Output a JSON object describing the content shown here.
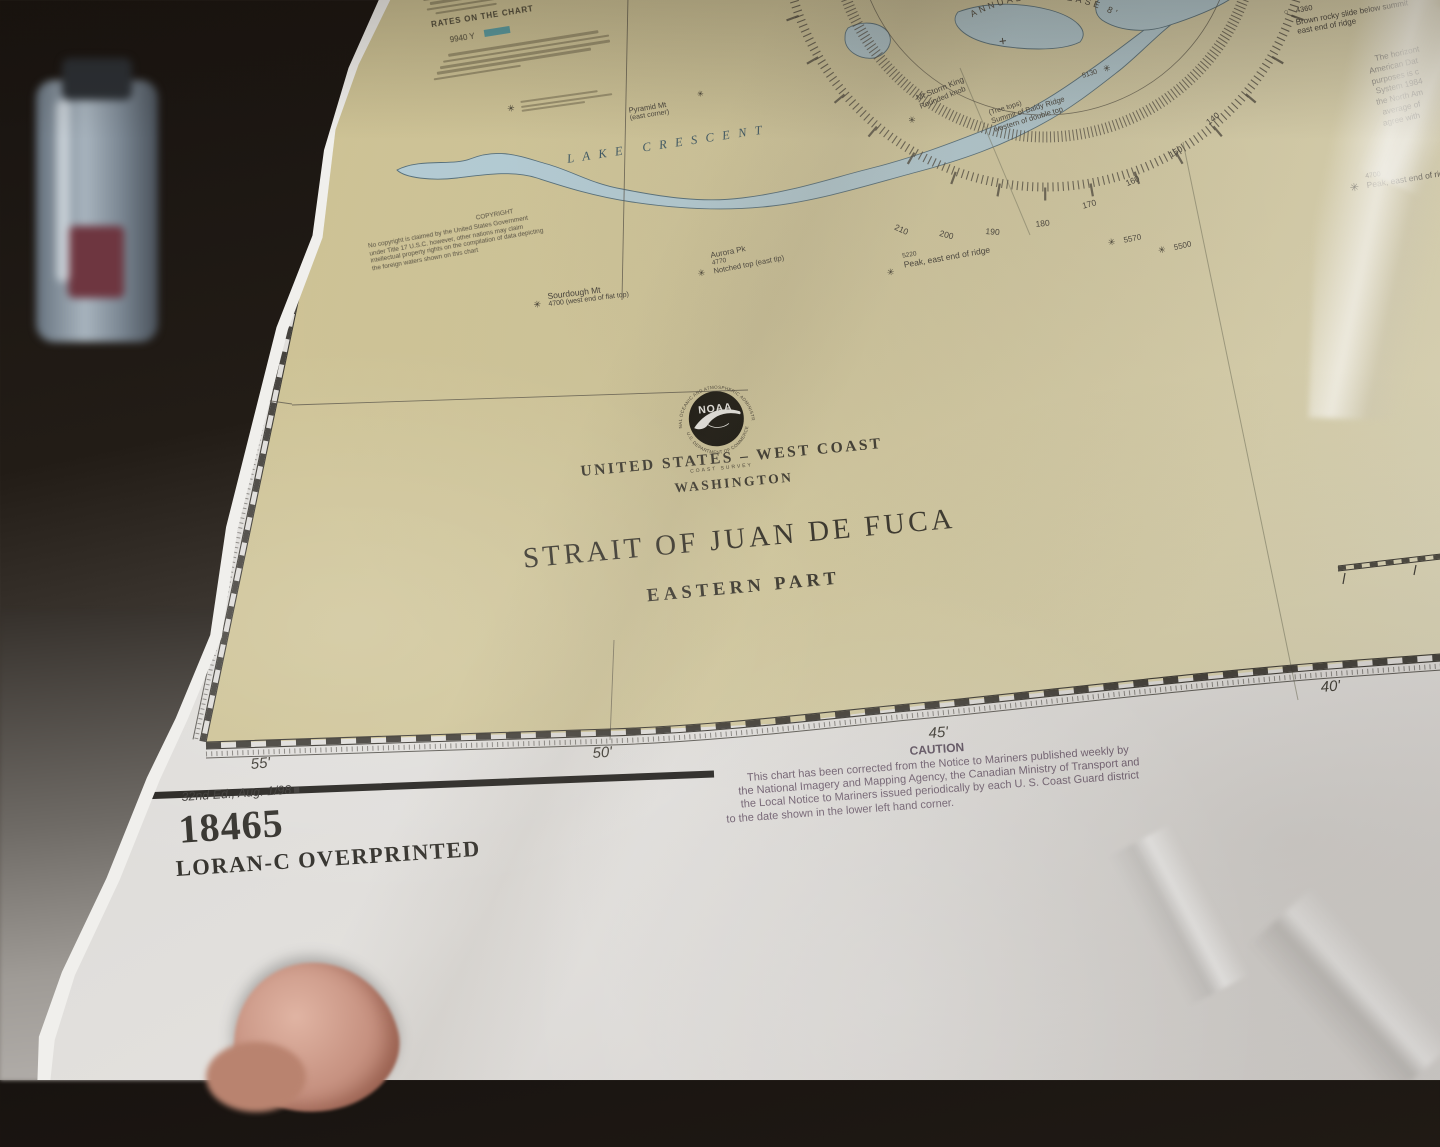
{
  "chart": {
    "number": "18465",
    "overprint": "LORAN-C OVERPRINTED",
    "edition": "32nd Ed., Aug. 1/98",
    "edition_mark": "■",
    "title": {
      "region": "UNITED STATES – WEST COAST",
      "state": "WASHINGTON",
      "name": "STRAIT OF JUAN DE FUCA",
      "part": "EASTERN PART"
    },
    "agency_seal": {
      "name": "NOAA",
      "ring_top": "NATIONAL OCEANIC AND ATMOSPHERIC ADMINISTRATION",
      "ring_bottom": "U.S. DEPARTMENT OF COMMERCE",
      "office": "COAST  SURVEY"
    },
    "caution": {
      "heading": "CAUTION",
      "line1": "This chart has been corrected from the Notice to Mariners published weekly by",
      "line2": "the National Imagery and Mapping Agency, the Canadian Ministry of Transport and",
      "line3": "the Local Notice to Mariners issued periodically by each U. S. Coast Guard district",
      "line4": "to the date shown in the lower left hand corner."
    },
    "copyright": {
      "heading": "COPYRIGHT",
      "line1": "No copyright is claimed by the United States Government",
      "line2": "under Title 17 U.S.C. however, other nations may claim",
      "line3": "intellectual property rights on the compilation of data depicting",
      "line4": "the foreign waters shown on this chart"
    },
    "legend": {
      "heading": "RATES ON THE CHART",
      "rate": "9940 Y",
      "accent": "#3e93a5"
    },
    "datum_note": {
      "l1": "The horizont",
      "l2": "American Dat",
      "l3": "purposes is c",
      "l4": "System 1984",
      "l5": "the North Am",
      "l6": "average of",
      "l7": "agree with"
    },
    "graticule": {
      "lat": "48°",
      "lon_ticks": [
        "55'",
        "50'",
        "45'",
        "40'"
      ],
      "plus_mark": "+"
    },
    "compass": {
      "ring_numbers": [
        "210",
        "200",
        "190",
        "180",
        "170",
        "160",
        "150",
        "140"
      ],
      "annual_note": "ANNUAL DECREASE 8'"
    },
    "water": {
      "lake_crescent": "LAKE CRESCENT"
    },
    "icons": {
      "peak": "✳",
      "open_peak": "○"
    },
    "peaks": {
      "sourdough": {
        "name": "Sourdough Mt",
        "detail": "4700 (west end of flat top)"
      },
      "pyramid": {
        "name": "Pyramid Mt",
        "detail": "(east corner)"
      },
      "aurora": {
        "name": "Aurora Pk",
        "elev": "4770",
        "detail": "Notched top (east tip)"
      },
      "ridge5220": {
        "elev": "5220",
        "detail": "Peak, east end of ridge"
      },
      "storm_king": {
        "name": "Mt Storm King",
        "detail": "Rounded knob"
      },
      "baldy": {
        "pre": "(Tree tops)",
        "name": "Summit of Baldy Ridge",
        "detail": "western of double top",
        "elev": "5130"
      },
      "p5570": {
        "elev": "5570"
      },
      "p5500": {
        "elev": "5500"
      },
      "p4360": {
        "elev": "4360",
        "detail1": "Brown rocky slide below summit",
        "detail2": "east end of ridge"
      },
      "p4700": {
        "elev": "4700",
        "detail": "Peak, east end of ridge"
      }
    },
    "colors": {
      "land": "#d1c79c",
      "water": "#b4ccd5",
      "caution_ink": "#6e5d6e",
      "print_ink": "#45413a"
    }
  }
}
